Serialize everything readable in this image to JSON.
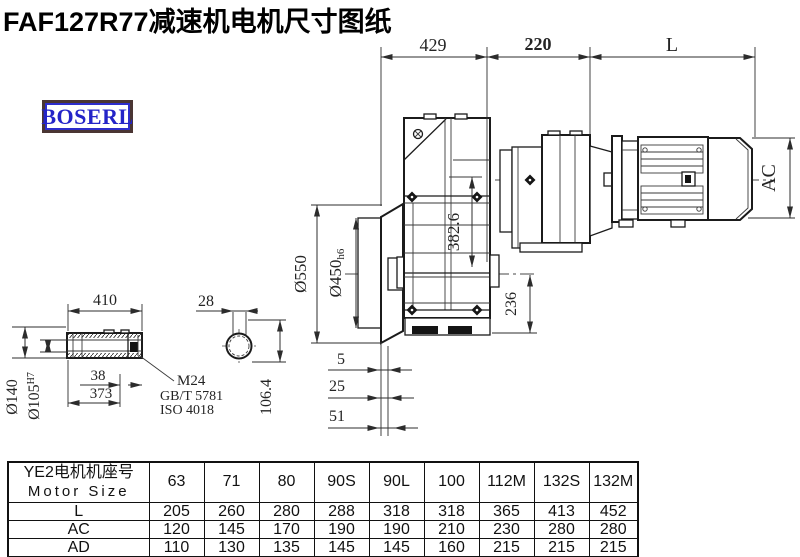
{
  "title": "FAF127R77减速机电机尺寸图纸",
  "brand": "BOSERL",
  "dims": {
    "top_429": "429",
    "top_220": "220",
    "top_L": "L",
    "ac": "AC",
    "flange_od": "Ø550",
    "spigot": "Ø450",
    "spigot_tol": "h6",
    "h382": "382.6",
    "h236": "236",
    "off5": "5",
    "off25": "25",
    "off51": "51",
    "shaft410": "410",
    "shaft38": "38",
    "shaft373": "373",
    "shaft_od": "Ø140",
    "bore": "Ø105",
    "bore_tol": "H7",
    "thread": "M24",
    "std1": "GB/T 5781",
    "std2": "ISO 4018",
    "key28": "28",
    "h1064": "106.4"
  },
  "table": {
    "header_cn": "YE2电机机座号",
    "header_en": "Motor Size",
    "columns": [
      "63",
      "71",
      "80",
      "90S",
      "90L",
      "100",
      "112M",
      "132S",
      "132M"
    ],
    "rows": [
      {
        "label": "L",
        "values": [
          "205",
          "260",
          "280",
          "288",
          "318",
          "318",
          "365",
          "413",
          "452"
        ]
      },
      {
        "label": "AC",
        "values": [
          "120",
          "145",
          "170",
          "190",
          "190",
          "210",
          "230",
          "280",
          "280"
        ]
      },
      {
        "label": "AD",
        "values": [
          "110",
          "130",
          "135",
          "145",
          "145",
          "160",
          "215",
          "215",
          "215"
        ]
      }
    ]
  }
}
